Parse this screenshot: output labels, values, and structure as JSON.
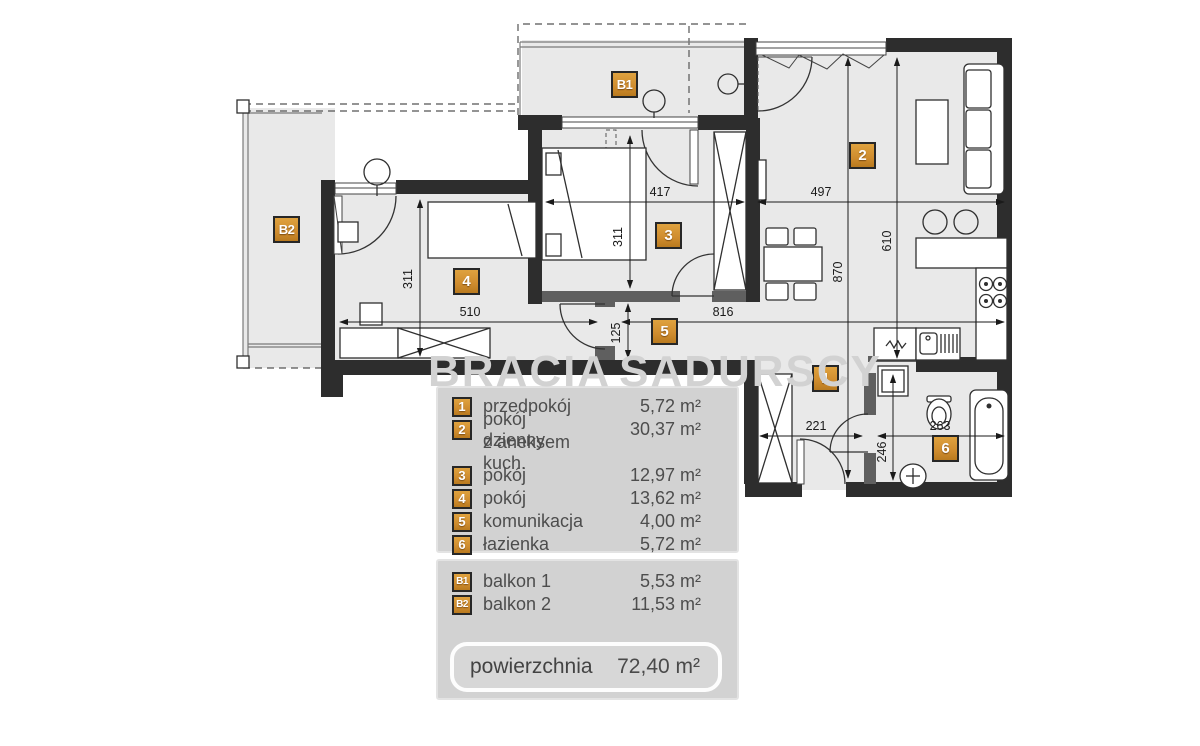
{
  "plan": {
    "badges": {
      "r1": "1",
      "r2": "2",
      "r3": "3",
      "r4": "4",
      "r5": "5",
      "r6": "6",
      "b1": "B1",
      "b2": "B2"
    },
    "dimensions": {
      "d417": "417",
      "d497": "497",
      "d311_room3": "311",
      "d311_room4": "311",
      "d870": "870",
      "d610": "610",
      "d510": "510",
      "d816": "816",
      "d125": "125",
      "d221": "221",
      "d263": "263",
      "d246": "246"
    }
  },
  "watermark": {
    "word_left": "BRACIA",
    "word_right": "SADURSCY"
  },
  "legend": {
    "rooms": [
      {
        "id": "1",
        "name": "przedpokój",
        "area": "5,72 m²"
      },
      {
        "id": "2",
        "name": "pokój dzienny",
        "name2": "z aneksem kuch.",
        "area": "30,37 m²"
      },
      {
        "id": "3",
        "name": "pokój",
        "area": "12,97 m²"
      },
      {
        "id": "4",
        "name": "pokój",
        "area": "13,62 m²"
      },
      {
        "id": "5",
        "name": "komunikacja",
        "area": "4,00 m²"
      },
      {
        "id": "6",
        "name": "łazienka",
        "area": "5,72 m²"
      }
    ],
    "balconies": [
      {
        "id": "B1",
        "name": "balkon 1",
        "area": "5,53 m²"
      },
      {
        "id": "B2",
        "name": "balkon 2",
        "area": "11,53 m²"
      }
    ],
    "total": {
      "label": "powierzchnia",
      "value": "72,40 m²"
    }
  },
  "colors": {
    "badge_orange": "#cf8c2e",
    "wall_dark": "#2d2d2d",
    "floor_gray": "#e9e9e9",
    "panel_gray": "#d2d2d2",
    "watermark_gray": "#d2d2d2"
  }
}
